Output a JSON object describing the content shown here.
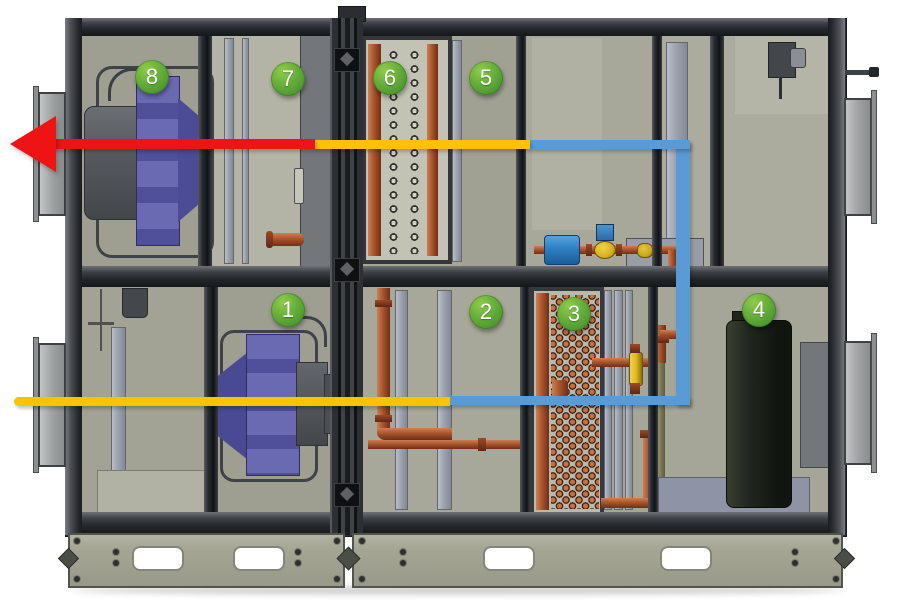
{
  "diagram": {
    "alt": "Cutaway side view of an air handling unit with eight numbered components and colored airflow lines",
    "badges": [
      {
        "label": "1"
      },
      {
        "label": "2"
      },
      {
        "label": "3"
      },
      {
        "label": "4"
      },
      {
        "label": "5"
      },
      {
        "label": "6"
      },
      {
        "label": "7"
      },
      {
        "label": "8"
      }
    ],
    "flow": {
      "red": "#ee1414",
      "yellow": "#ffc103",
      "blue": "#5b9bd5"
    },
    "palette": {
      "badge_green": "#57a033",
      "cabinet_olive": "#a6a697",
      "frame_dark": "#2c2f33",
      "copper": "#a9552c",
      "fan_purple": "#5757a3",
      "tank_dark": "#1c211a",
      "component_blue": "#2d7fc2",
      "valve_brass": "#d8b01f"
    }
  }
}
